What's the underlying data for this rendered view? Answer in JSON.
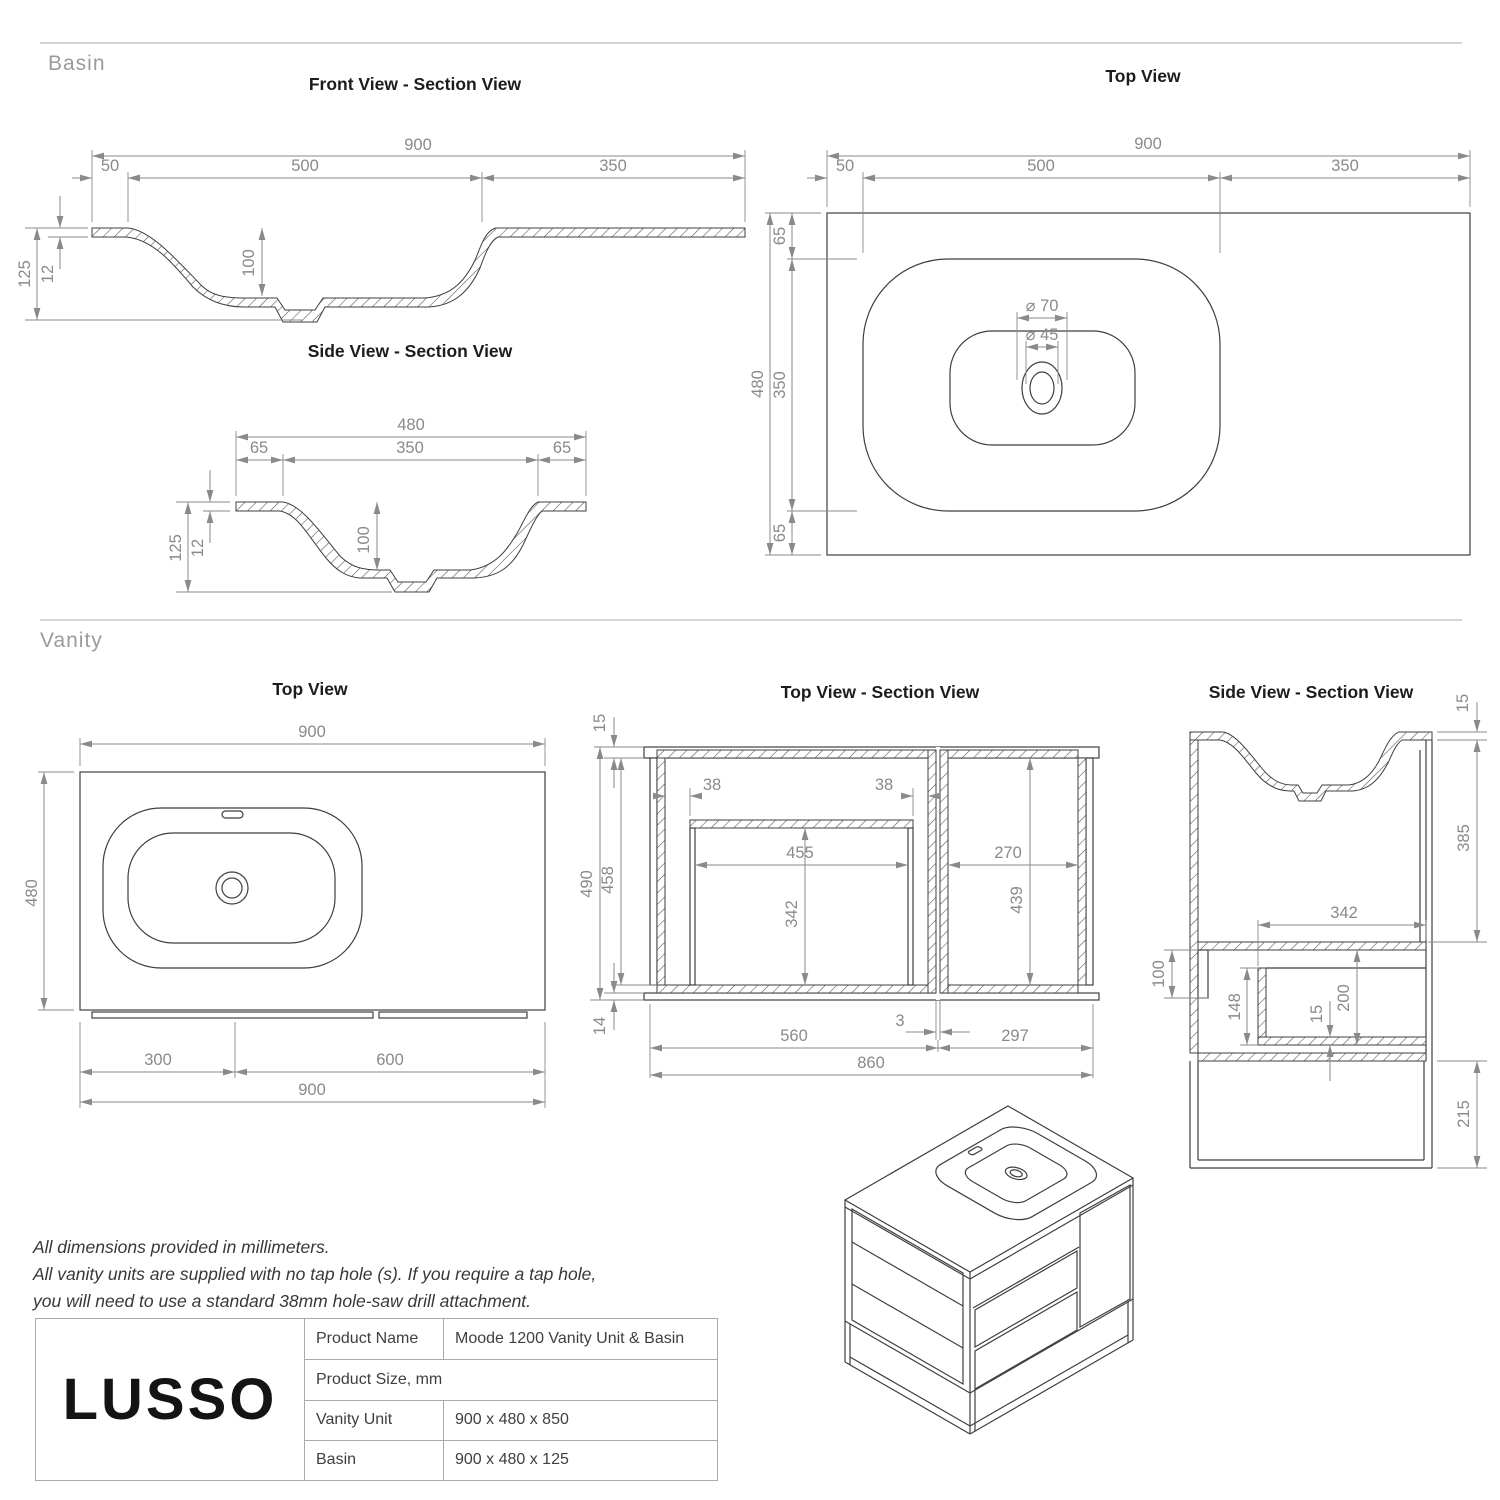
{
  "sections": {
    "basin_label": "Basin",
    "vanity_label": "Vanity"
  },
  "views": {
    "basin_front": {
      "title": "Front View - Section View",
      "dims": {
        "overall_width": "900",
        "left_ledge": "50",
        "bowl_width": "500",
        "right_ledge": "350",
        "basin_height": "125",
        "top_thickness": "12",
        "bowl_depth": "100"
      }
    },
    "basin_side": {
      "title": "Side View - Section View",
      "dims": {
        "overall_depth": "480",
        "front_ledge": "65",
        "bowl_depth": "350",
        "back_ledge": "65",
        "basin_height": "125",
        "top_thickness": "12",
        "bowl_inner_depth": "100"
      }
    },
    "basin_top": {
      "title": "Top View",
      "dims": {
        "overall_width": "900",
        "left_ledge": "50",
        "bowl_width": "500",
        "right_ledge": "350",
        "overall_depth": "480",
        "top_ledge": "65",
        "bowl_depth": "350",
        "bottom_ledge": "65",
        "waste_outer": "⌀ 70",
        "waste_inner": "⌀ 45"
      }
    },
    "vanity_top": {
      "title": "Top View",
      "dims": {
        "overall_width": "900",
        "overall_depth": "480",
        "left_split": "300",
        "right_split": "600",
        "total_width": "900"
      }
    },
    "vanity_section": {
      "title": "Top View - Section View",
      "dims": {
        "top_thickness": "15",
        "overall_depth": "490",
        "internal_depth": "458",
        "left_gap": "38",
        "right_gap": "38",
        "drawer_width": "455",
        "drawer_depth": "342",
        "door_width": "270",
        "door_depth": "439",
        "bottom_thickness": "14",
        "left_width": "560",
        "divider_gap": "3",
        "right_width": "297",
        "overall_width": "860"
      }
    },
    "vanity_side": {
      "title": "Side View - Section View",
      "dims": {
        "top_thickness": "15",
        "upper_depth": "385",
        "shelf_width": "342",
        "rail_height": "100",
        "drawer_height": "148",
        "panel_thickness": "15",
        "lower_depth": "200",
        "frame_height": "215"
      }
    }
  },
  "notes": {
    "line1": "All dimensions provided in millimeters.",
    "line2": "All vanity units are supplied with no tap hole (s). If you require a tap hole,",
    "line3": "you will need to use a standard 38mm hole-saw drill attachment."
  },
  "logo": {
    "brand": "LUSSO"
  },
  "spec_table": {
    "rows": [
      {
        "label": "Product Name",
        "value": "Moode 1200 Vanity Unit & Basin"
      },
      {
        "label": "Product Size, mm",
        "value": ""
      },
      {
        "label": "Vanity Unit",
        "value": "900 x 480 x 850"
      },
      {
        "label": "Basin",
        "value": "900 x 480 x 125"
      }
    ]
  },
  "colors": {
    "object_line": "#3f3f3f",
    "dimension": "#8a8a8a",
    "title": "#1c1c1c",
    "section_label": "#9b9b9b",
    "divider": "#d4d4d4",
    "table_border": "#a9a9a9"
  }
}
